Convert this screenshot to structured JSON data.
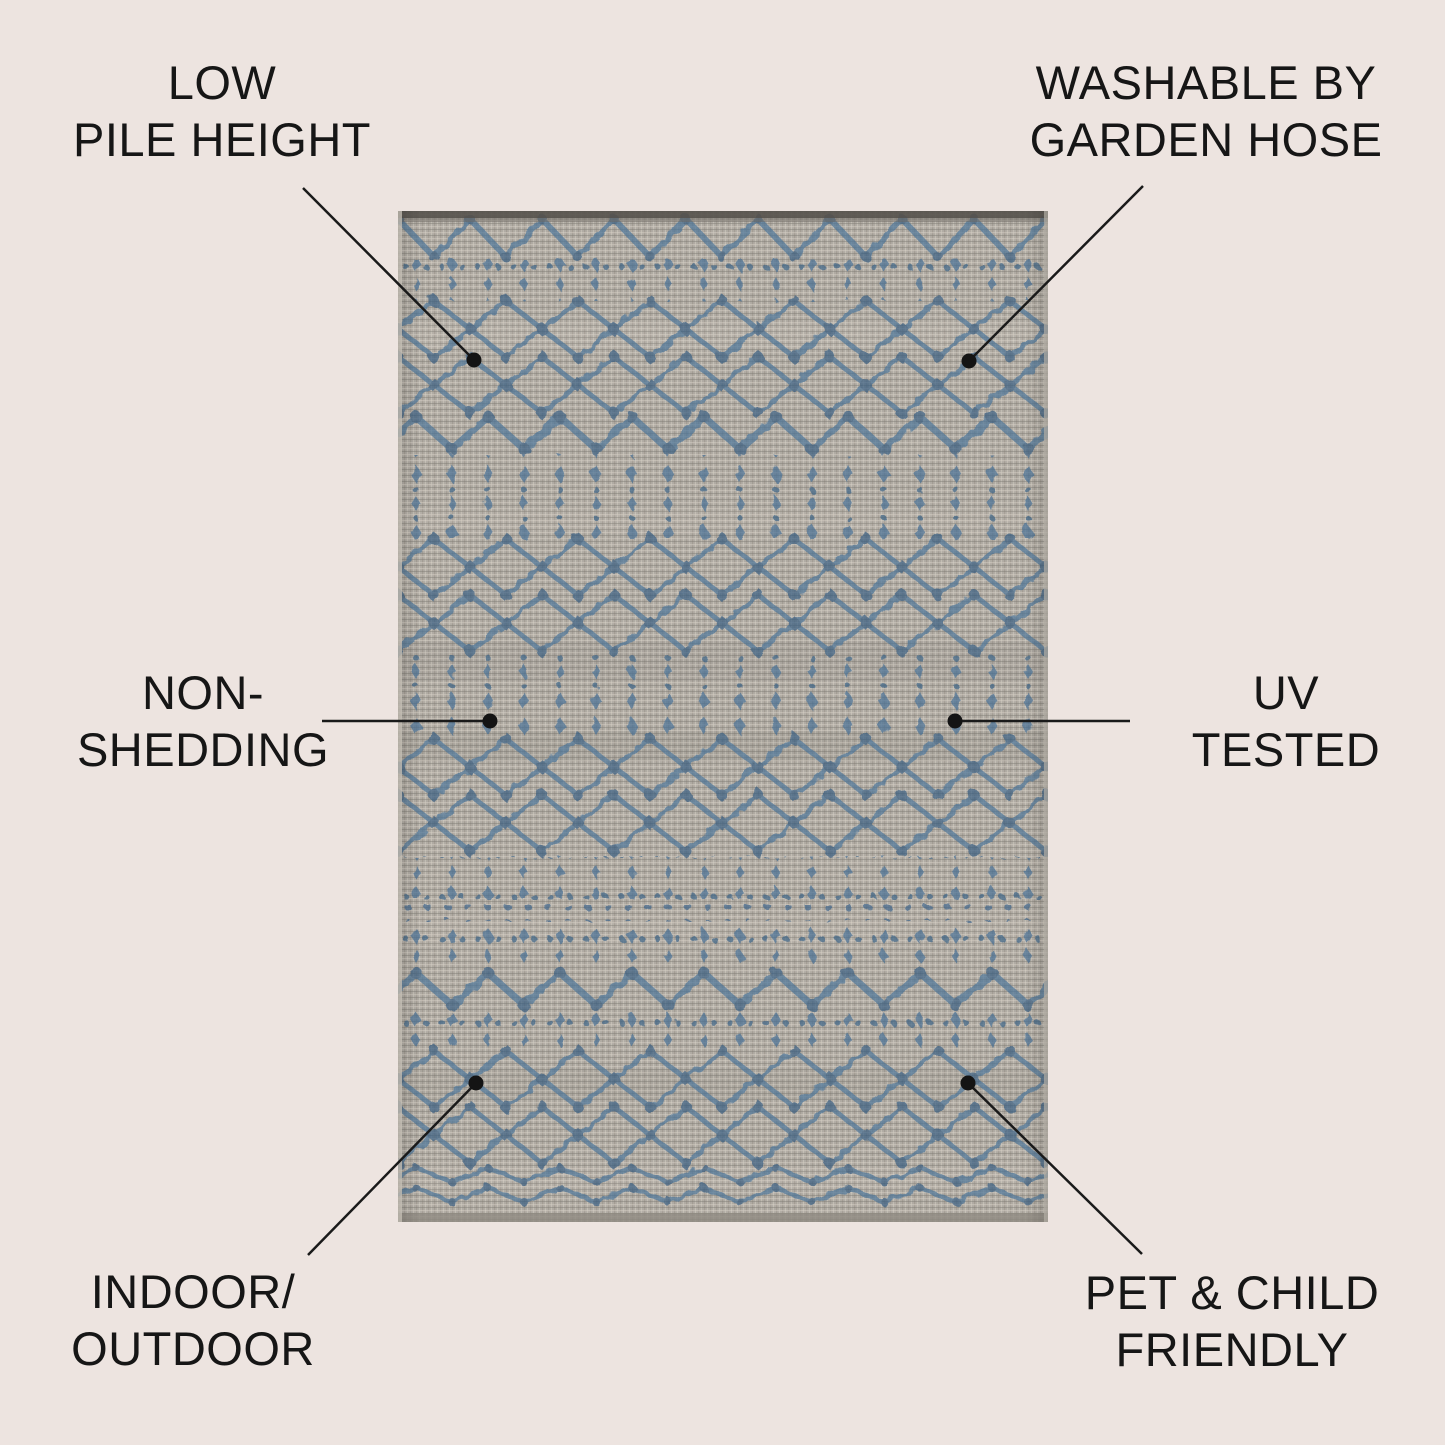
{
  "colors": {
    "background": "#ede4e0",
    "text": "#161616",
    "leader_line": "#1a1a1a",
    "rug_base_gray": "#b3aea6",
    "rug_pattern_blue": "#3f6f9a",
    "rug_pattern_blue_dark": "#2a5680"
  },
  "rug": {
    "alt": "Gray flatweave outdoor rug with blue Moroccan diamond trellis pattern"
  },
  "callouts": [
    {
      "id": "low-pile-height",
      "line1": "LOW",
      "line2": "PILE HEIGHT"
    },
    {
      "id": "washable-by-garden-hose",
      "line1": "WASHABLE BY",
      "line2": "GARDEN HOSE"
    },
    {
      "id": "non-shedding",
      "line1": "NON-",
      "line2": "SHEDDING"
    },
    {
      "id": "uv-tested",
      "line1": "UV",
      "line2": "TESTED"
    },
    {
      "id": "indoor-outdoor",
      "line1": "INDOOR/",
      "line2": "OUTDOOR"
    },
    {
      "id": "pet-child-friendly",
      "line1": "PET & CHILD",
      "line2": "FRIENDLY"
    }
  ]
}
